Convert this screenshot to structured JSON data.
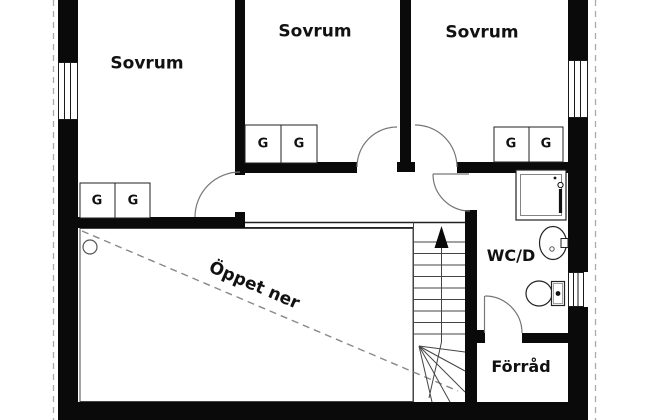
{
  "colors": {
    "wall": "#0a0a0a",
    "background": "#ffffff",
    "text": "#111111",
    "thin_line": "#444444",
    "door_arc": "#777777",
    "boundary_dash": "#aaaaaa",
    "void_dash": "#888888"
  },
  "rooms": {
    "bedroom_1": {
      "label": "Sovrum"
    },
    "bedroom_2": {
      "label": "Sovrum"
    },
    "bedroom_3": {
      "label": "Sovrum"
    },
    "wc_shower": {
      "label": "WC/D"
    },
    "storage": {
      "label": "Förråd"
    },
    "open_to_below": {
      "label": "Öppet ner"
    }
  },
  "wardrobes": {
    "cells": [
      "G",
      "G",
      "G",
      "G",
      "G",
      "G"
    ]
  },
  "icons": {
    "stairs_up_arrow": "filled triangle pointing up",
    "shower": "square with inner frame and mixer",
    "washbasin": "oval basin with tap",
    "toilet": "bowl with cistern",
    "window": "wall opening with frame lines",
    "column": "small circle"
  }
}
